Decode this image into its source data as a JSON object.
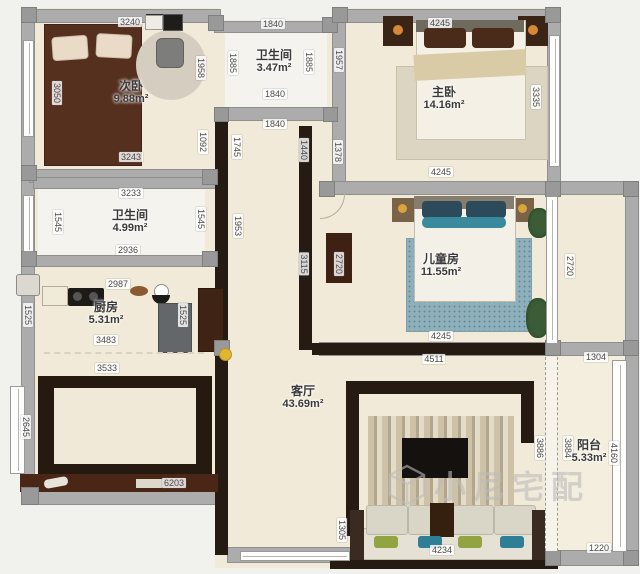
{
  "watermark": {
    "text": "小尼宅配",
    "logo_icon": "cube-house-logo"
  },
  "rooms": [
    {
      "name": "次卧",
      "area": "9.88m²",
      "x": 131,
      "y": 93
    },
    {
      "name": "卫生间",
      "area": "3.47m²",
      "x": 274,
      "y": 62
    },
    {
      "name": "主卧",
      "area": "14.16m²",
      "x": 444,
      "y": 99
    },
    {
      "name": "卫生间",
      "area": "4.99m²",
      "x": 130,
      "y": 222
    },
    {
      "name": "厨房",
      "area": "5.31m²",
      "x": 106,
      "y": 314
    },
    {
      "name": "儿童房",
      "area": "11.55m²",
      "x": 441,
      "y": 266
    },
    {
      "name": "客厅",
      "area": "43.69m²",
      "x": 303,
      "y": 398
    },
    {
      "name": "阳台",
      "area": "5.33m²",
      "x": 589,
      "y": 452
    }
  ],
  "dimensions": [
    {
      "t": "3240",
      "x": 130,
      "y": 22
    },
    {
      "t": "1840",
      "x": 273,
      "y": 24
    },
    {
      "t": "4245",
      "x": 440,
      "y": 23
    },
    {
      "t": "1840",
      "x": 275,
      "y": 94
    },
    {
      "t": "1840",
      "x": 275,
      "y": 124
    },
    {
      "t": "3243",
      "x": 131,
      "y": 157
    },
    {
      "t": "3233",
      "x": 131,
      "y": 193
    },
    {
      "t": "2936",
      "x": 128,
      "y": 250
    },
    {
      "t": "2987",
      "x": 118,
      "y": 284
    },
    {
      "t": "3483",
      "x": 106,
      "y": 340
    },
    {
      "t": "3533",
      "x": 107,
      "y": 368
    },
    {
      "t": "4245",
      "x": 441,
      "y": 172
    },
    {
      "t": "4245",
      "x": 441,
      "y": 336
    },
    {
      "t": "4511",
      "x": 434,
      "y": 359
    },
    {
      "t": "1304",
      "x": 596,
      "y": 357
    },
    {
      "t": "6203",
      "x": 174,
      "y": 483
    },
    {
      "t": "4234",
      "x": 442,
      "y": 550
    },
    {
      "t": "1220",
      "x": 599,
      "y": 548
    },
    {
      "t": "3050",
      "x": 57,
      "y": 93,
      "v": 1
    },
    {
      "t": "1958",
      "x": 201,
      "y": 68,
      "v": 1
    },
    {
      "t": "1092",
      "x": 203,
      "y": 142,
      "v": 1
    },
    {
      "t": "1885",
      "x": 233,
      "y": 63,
      "v": 1
    },
    {
      "t": "1885",
      "x": 309,
      "y": 62,
      "v": 1
    },
    {
      "t": "1957",
      "x": 339,
      "y": 60,
      "v": 1
    },
    {
      "t": "1378",
      "x": 338,
      "y": 152,
      "v": 1
    },
    {
      "t": "1745",
      "x": 237,
      "y": 147,
      "v": 1
    },
    {
      "t": "1440",
      "x": 304,
      "y": 150,
      "v": 1
    },
    {
      "t": "1545",
      "x": 58,
      "y": 222,
      "v": 1
    },
    {
      "t": "1545",
      "x": 201,
      "y": 219,
      "v": 1
    },
    {
      "t": "1525",
      "x": 28,
      "y": 315,
      "v": 1
    },
    {
      "t": "1525",
      "x": 183,
      "y": 315,
      "v": 1
    },
    {
      "t": "1953",
      "x": 238,
      "y": 226,
      "v": 1
    },
    {
      "t": "3115",
      "x": 304,
      "y": 264,
      "v": 1
    },
    {
      "t": "3335",
      "x": 536,
      "y": 97,
      "v": 1
    },
    {
      "t": "2720",
      "x": 339,
      "y": 264,
      "v": 1
    },
    {
      "t": "2720",
      "x": 570,
      "y": 266,
      "v": 1
    },
    {
      "t": "2645",
      "x": 26,
      "y": 427,
      "v": 1
    },
    {
      "t": "3886",
      "x": 540,
      "y": 448,
      "v": 1
    },
    {
      "t": "3884",
      "x": 568,
      "y": 448,
      "v": 1
    },
    {
      "t": "4160",
      "x": 614,
      "y": 453,
      "v": 1
    },
    {
      "t": "1305",
      "x": 342,
      "y": 530,
      "v": 1
    }
  ]
}
